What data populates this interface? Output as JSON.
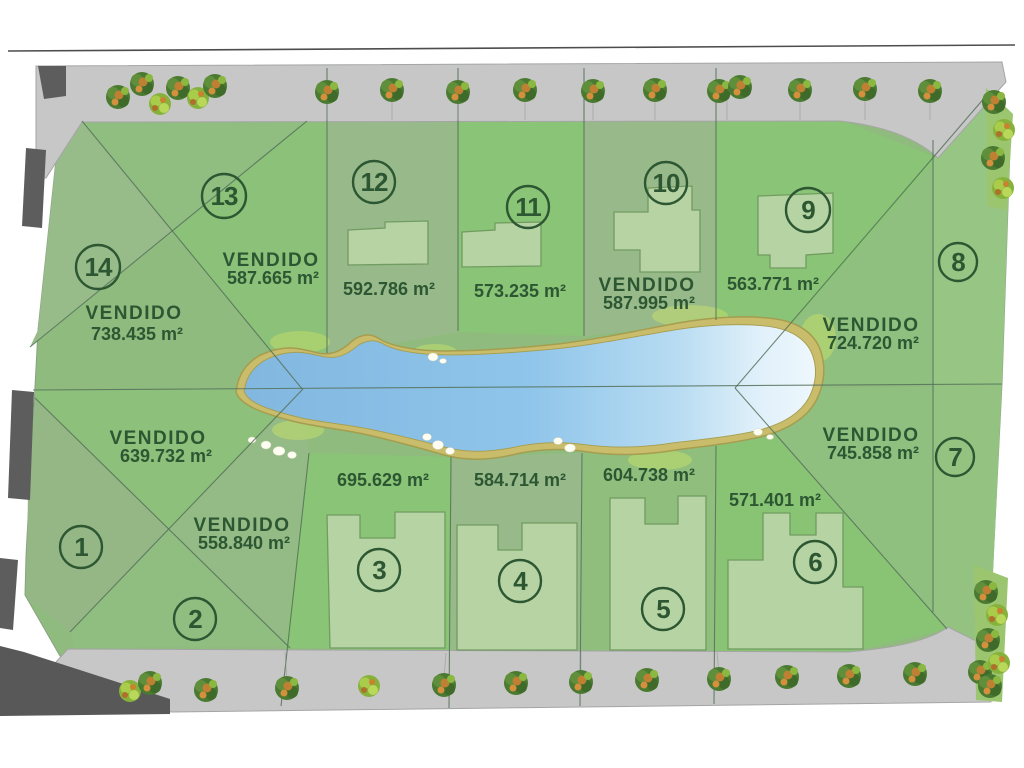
{
  "plan": {
    "sold_label_text": "VENDIDO",
    "unit": "m²",
    "lots": [
      {
        "number": "1",
        "area": "639.732 m²",
        "status": "VENDIDO"
      },
      {
        "number": "2",
        "area": "558.840 m²",
        "status": "VENDIDO"
      },
      {
        "number": "3",
        "area": "695.629 m²",
        "status": ""
      },
      {
        "number": "4",
        "area": "584.714 m²",
        "status": ""
      },
      {
        "number": "5",
        "area": "604.738 m²",
        "status": ""
      },
      {
        "number": "6",
        "area": "571.401 m²",
        "status": ""
      },
      {
        "number": "7",
        "area": "745.858 m²",
        "status": "VENDIDO"
      },
      {
        "number": "8",
        "area": "724.720 m²",
        "status": "VENDIDO"
      },
      {
        "number": "9",
        "area": "563.771 m²",
        "status": ""
      },
      {
        "number": "10",
        "area": "587.995 m²",
        "status": "VENDIDO"
      },
      {
        "number": "11",
        "area": "573.235 m²",
        "status": ""
      },
      {
        "number": "12",
        "area": "592.786 m²",
        "status": ""
      },
      {
        "number": "13",
        "area": "587.665 m²",
        "status": "VENDIDO"
      },
      {
        "number": "14",
        "area": "738.435 m²",
        "status": "VENDIDO"
      }
    ],
    "colors": {
      "site_green": "#8fbc7e",
      "road_gray": "#c7c7c7",
      "wall_dark_gray": "#5d5d5d",
      "lake_blue": "#86bce2",
      "lake_shore_tan": "#c9bd6b",
      "label_green": "#2d5733"
    }
  }
}
